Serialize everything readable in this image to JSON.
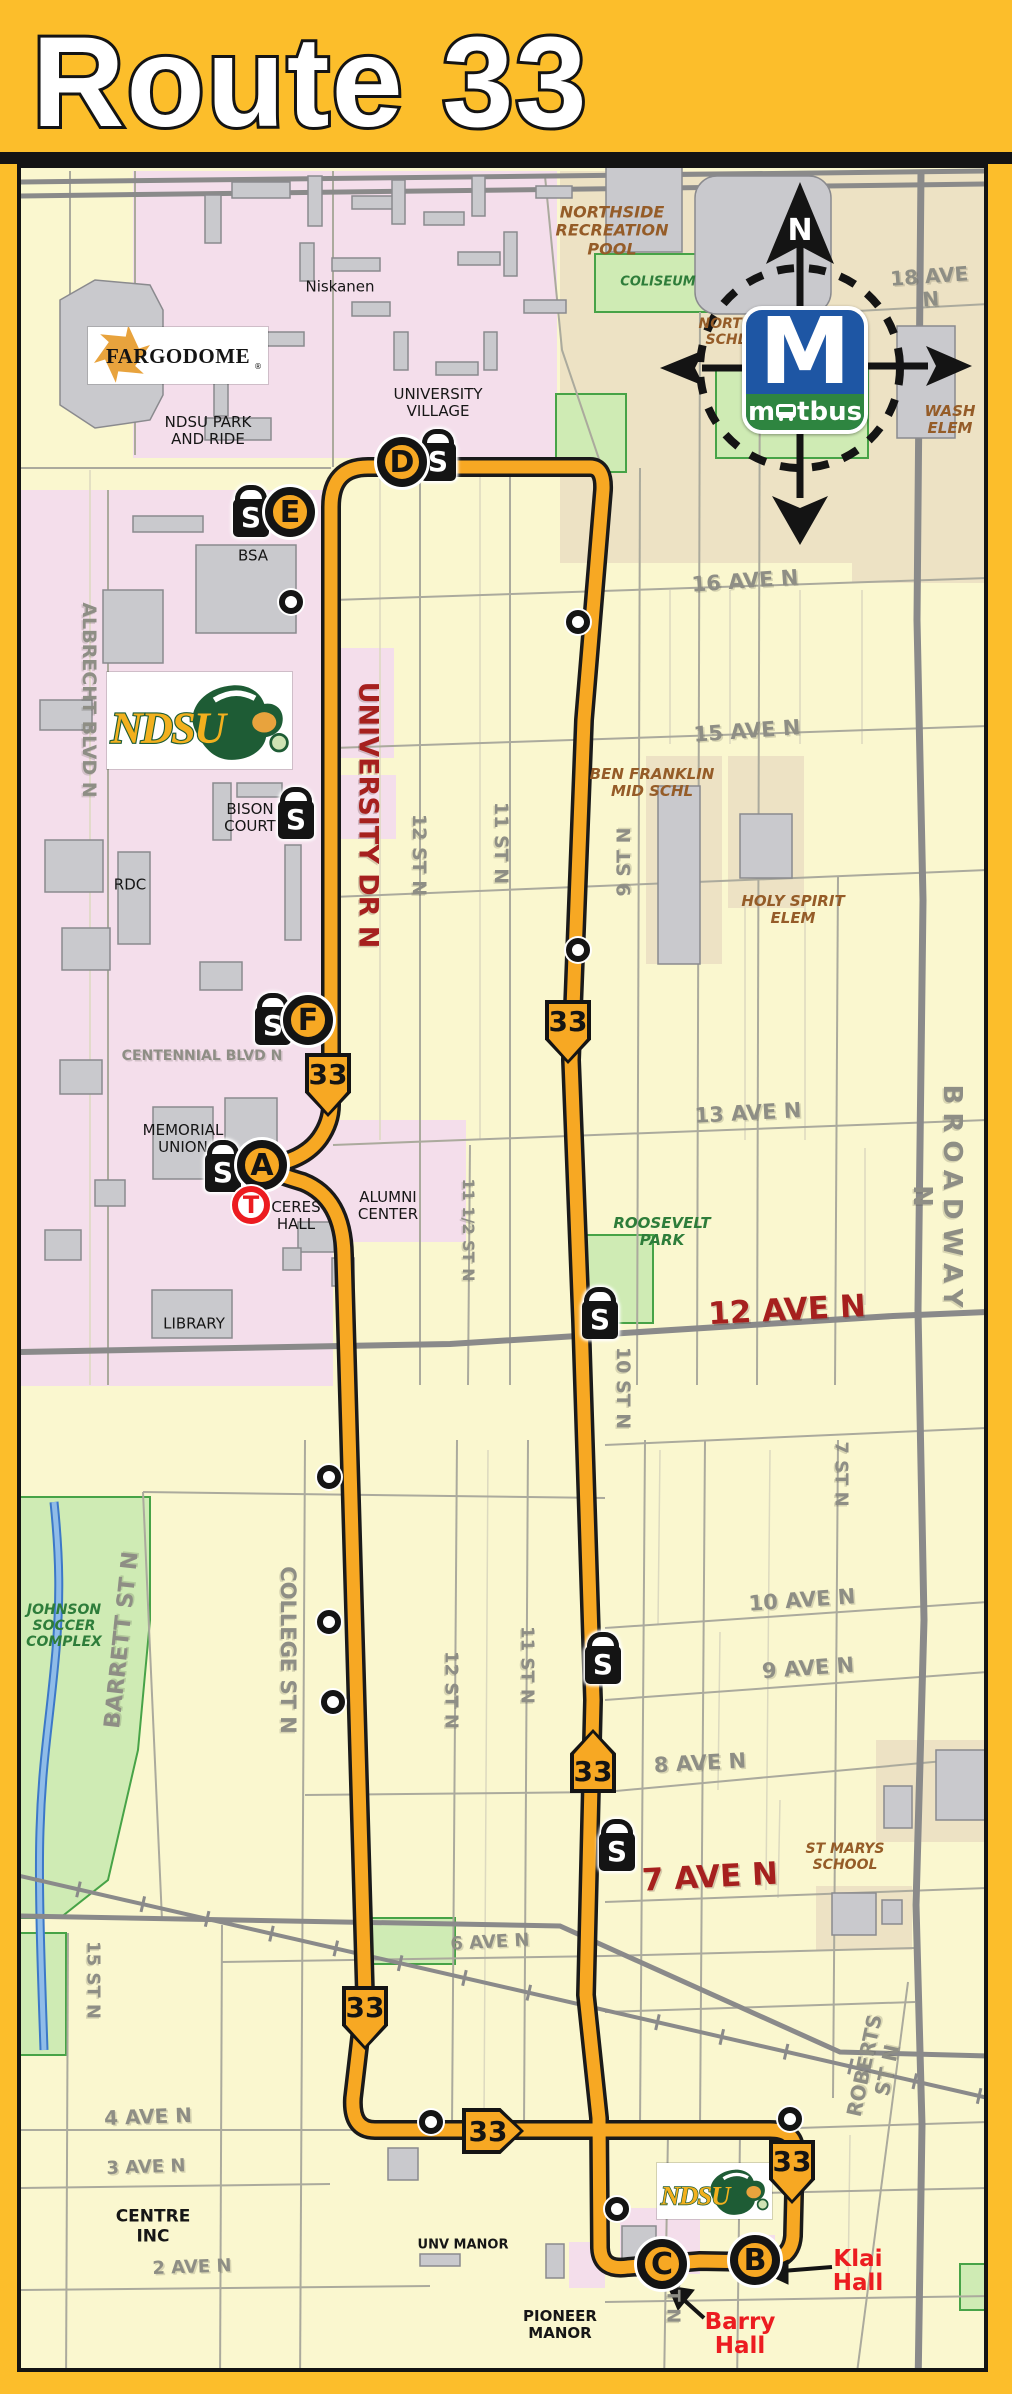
{
  "header": {
    "title": "Route 33"
  },
  "branding": {
    "matbus": {
      "m": "M",
      "word_pre": "m",
      "word_post": "tbus"
    },
    "fargodome": {
      "text": "FARGODOME",
      "reg": "®"
    },
    "ndsu": {
      "text": "NDSU"
    }
  },
  "compass": {
    "north_label": "N"
  },
  "route": {
    "number": "33",
    "color": "#F7A823"
  },
  "map_labels": [
    {
      "id": "street-18-ave-n",
      "t": "18 AVE N",
      "c": "g",
      "x": 930,
      "y": 288,
      "r": -4,
      "fs": 20
    },
    {
      "id": "street-16-ave-n",
      "t": "16 AVE N",
      "c": "g",
      "x": 745,
      "y": 581,
      "r": -4,
      "fs": 21
    },
    {
      "id": "street-15-ave-n",
      "t": "15 AVE N",
      "c": "g",
      "x": 747,
      "y": 731,
      "r": -4,
      "fs": 21
    },
    {
      "id": "street-13-ave-n",
      "t": "13 AVE N",
      "c": "g",
      "x": 748,
      "y": 1113,
      "r": -3,
      "fs": 21
    },
    {
      "id": "street-10-ave-n",
      "t": "10 AVE N",
      "c": "g",
      "x": 802,
      "y": 1600,
      "r": -4,
      "fs": 21
    },
    {
      "id": "street-9-ave-n",
      "t": "9 AVE N",
      "c": "g",
      "x": 808,
      "y": 1668,
      "r": -4,
      "fs": 21
    },
    {
      "id": "street-8-ave-n",
      "t": "8 AVE N",
      "c": "g",
      "x": 700,
      "y": 1763,
      "r": -3,
      "fs": 21
    },
    {
      "id": "street-6-ave-n",
      "t": "6 AVE N",
      "c": "g",
      "x": 490,
      "y": 1943,
      "r": -3,
      "fs": 18
    },
    {
      "id": "street-4-ave-n",
      "t": "4 AVE N",
      "c": "g",
      "x": 148,
      "y": 2117,
      "r": -2,
      "fs": 20
    },
    {
      "id": "street-3-ave-n",
      "t": "3 AVE N",
      "c": "g",
      "x": 146,
      "y": 2168,
      "r": -2,
      "fs": 18
    },
    {
      "id": "street-2-ave-n",
      "t": "2 AVE N",
      "c": "g",
      "x": 192,
      "y": 2268,
      "r": -2,
      "fs": 18
    },
    {
      "id": "street-centennial",
      "t": "CENTENNIAL BLVD N",
      "c": "g",
      "x": 202,
      "y": 1056,
      "r": 0,
      "fs": 14
    },
    {
      "id": "street-albrecht",
      "t": "ALBRECHT BLVD N",
      "c": "g",
      "x": 88,
      "y": 700,
      "r": 90,
      "fs": 19
    },
    {
      "id": "street-12-st-n-upper",
      "t": "12 ST N",
      "c": "g",
      "x": 418,
      "y": 855,
      "r": 90,
      "fs": 19
    },
    {
      "id": "street-11-st-n-upper",
      "t": "11 ST N",
      "c": "g",
      "x": 500,
      "y": 843,
      "r": 90,
      "fs": 19
    },
    {
      "id": "street-11half-st-n",
      "t": "11 1/2 ST N",
      "c": "g",
      "x": 468,
      "y": 1230,
      "r": 90,
      "fs": 16
    },
    {
      "id": "street-10-st-n",
      "t": "10 ST N",
      "c": "g",
      "x": 622,
      "y": 1388,
      "r": 90,
      "fs": 19
    },
    {
      "id": "street-7-st-n",
      "t": "7 ST N",
      "c": "g",
      "x": 840,
      "y": 1474,
      "r": 90,
      "fs": 18
    },
    {
      "id": "street-broadway-n",
      "t": "BROADWAY N",
      "c": "g",
      "x": 936,
      "y": 1200,
      "r": 90,
      "fs": 26,
      "ls": 8
    },
    {
      "id": "street-college-st-n",
      "t": "COLLEGE ST N",
      "c": "g",
      "x": 288,
      "y": 1650,
      "r": 90,
      "fs": 21
    },
    {
      "id": "street-12-st-n-lower",
      "t": "12 ST N",
      "c": "g",
      "x": 450,
      "y": 1690,
      "r": 90,
      "fs": 18
    },
    {
      "id": "street-11-st-n-lower",
      "t": "11 ST N",
      "c": "g",
      "x": 526,
      "y": 1665,
      "r": 90,
      "fs": 18
    },
    {
      "id": "street-15-st-n",
      "t": "15 ST N",
      "c": "g",
      "x": 92,
      "y": 1980,
      "r": 90,
      "fs": 18
    },
    {
      "id": "street-st-n",
      "t": "ST N",
      "c": "g",
      "x": 672,
      "y": 2300,
      "r": 90,
      "fs": 18
    },
    {
      "id": "street-9-st-n",
      "t": "9 ST N",
      "c": "g",
      "x": 625,
      "y": 862,
      "r": -90,
      "fs": 19
    },
    {
      "id": "street-barrett-st-n",
      "t": "BARRETT ST N",
      "c": "g",
      "x": 122,
      "y": 1640,
      "r": -84,
      "fs": 22
    },
    {
      "id": "street-roberts-st-n",
      "t": "ROBERTS ST N",
      "c": "g",
      "x": 876,
      "y": 2068,
      "r": -78,
      "fs": 20
    },
    {
      "id": "street-12-ave-n",
      "t": "12 AVE N",
      "c": "r",
      "x": 787,
      "y": 1311,
      "r": -3,
      "fs": 31
    },
    {
      "id": "street-7-ave-n",
      "t": "7 AVE N",
      "c": "r",
      "x": 710,
      "y": 1878,
      "r": -3,
      "fs": 31
    },
    {
      "id": "street-university-dr-n",
      "t": "UNIVERSITY DR N",
      "c": "r",
      "x": 368,
      "y": 815,
      "r": 90,
      "fs": 27
    },
    {
      "id": "place-niskanen",
      "t": "Niskanen",
      "c": "p",
      "x": 340,
      "y": 287,
      "r": 0,
      "fs": 15
    },
    {
      "id": "place-university-village",
      "t": "UNIVERSITY\nVILLAGE",
      "c": "p",
      "x": 438,
      "y": 403,
      "r": 0,
      "fs": 15
    },
    {
      "id": "place-ndsu-park-and-ride",
      "t": "NDSU PARK\nAND RIDE",
      "c": "p",
      "x": 208,
      "y": 431,
      "r": 0,
      "fs": 15
    },
    {
      "id": "place-bsa",
      "t": "BSA",
      "c": "p",
      "x": 253,
      "y": 556,
      "r": 0,
      "fs": 15
    },
    {
      "id": "place-bison-court",
      "t": "BISON\nCOURT",
      "c": "p",
      "x": 250,
      "y": 818,
      "r": 0,
      "fs": 15
    },
    {
      "id": "place-rdc",
      "t": "RDC",
      "c": "p",
      "x": 130,
      "y": 885,
      "r": 0,
      "fs": 15
    },
    {
      "id": "place-memorial-union",
      "t": "MEMORIAL\nUNION",
      "c": "p",
      "x": 183,
      "y": 1139,
      "r": 0,
      "fs": 15
    },
    {
      "id": "place-ceres-hall",
      "t": "CERES\nHALL",
      "c": "p",
      "x": 296,
      "y": 1216,
      "r": 0,
      "fs": 15
    },
    {
      "id": "place-alumni-center",
      "t": "ALUMNI\nCENTER",
      "c": "p",
      "x": 388,
      "y": 1206,
      "r": 0,
      "fs": 15
    },
    {
      "id": "place-library",
      "t": "LIBRARY",
      "c": "p",
      "x": 194,
      "y": 1324,
      "r": 0,
      "fs": 15
    },
    {
      "id": "place-centre-inc",
      "t": "CENTRE\nINC",
      "c": "p",
      "x": 153,
      "y": 2227,
      "r": 0,
      "fs": 17,
      "b": 1
    },
    {
      "id": "place-unv-manor",
      "t": "UNV MANOR",
      "c": "p",
      "x": 463,
      "y": 2246,
      "r": 0,
      "fs": 13,
      "b": 1
    },
    {
      "id": "place-pioneer-manor",
      "t": "PIONEER\nMANOR",
      "c": "p",
      "x": 560,
      "y": 2325,
      "r": 0,
      "fs": 15,
      "b": 1
    },
    {
      "id": "place-northside-pool",
      "t": "NORTHSIDE\nRECREATION\nPOOL",
      "c": "b",
      "x": 612,
      "y": 231,
      "r": 0,
      "fs": 16
    },
    {
      "id": "place-north-schl",
      "t": "NORTH\nSCHL",
      "c": "b",
      "x": 726,
      "y": 332,
      "r": 0,
      "fs": 14
    },
    {
      "id": "place-wash-elem",
      "t": "WASH\nELEM",
      "c": "b",
      "x": 950,
      "y": 420,
      "r": 0,
      "fs": 15
    },
    {
      "id": "place-ben-franklin",
      "t": "BEN FRANKLIN\nMID SCHL",
      "c": "b",
      "x": 652,
      "y": 783,
      "r": 0,
      "fs": 15
    },
    {
      "id": "place-holy-spirit",
      "t": "HOLY SPIRIT\nELEM",
      "c": "b",
      "x": 793,
      "y": 910,
      "r": 0,
      "fs": 15
    },
    {
      "id": "place-st-marys",
      "t": "ST MARYS\nSCHOOL",
      "c": "b",
      "x": 845,
      "y": 1857,
      "r": 0,
      "fs": 14
    },
    {
      "id": "place-coliseum",
      "t": "COLISEUM",
      "c": "gr",
      "x": 658,
      "y": 283,
      "r": 0,
      "fs": 13
    },
    {
      "id": "place-roosevelt-park",
      "t": "ROOSEVELT\nPARK",
      "c": "gr",
      "x": 662,
      "y": 1232,
      "r": 0,
      "fs": 15
    },
    {
      "id": "place-johnson-soccer",
      "t": "JOHNSON\nSOCCER\nCOMPLEX",
      "c": "gr",
      "x": 64,
      "y": 1626,
      "r": 0,
      "fs": 14
    },
    {
      "id": "poi-klai-hall",
      "t": "Klai\nHall",
      "c": "poi",
      "x": 858,
      "y": 2271,
      "r": 0,
      "fs": 23
    },
    {
      "id": "poi-barry-hall",
      "t": "Barry\nHall",
      "c": "poi",
      "x": 740,
      "y": 2334,
      "r": 0,
      "fs": 23
    }
  ],
  "stops": {
    "lettered": [
      {
        "letter": "A",
        "x": 262,
        "y": 1165
      },
      {
        "letter": "B",
        "x": 755,
        "y": 2260
      },
      {
        "letter": "C",
        "x": 662,
        "y": 2264
      },
      {
        "letter": "D",
        "x": 402,
        "y": 462
      },
      {
        "letter": "E",
        "x": 290,
        "y": 512
      },
      {
        "letter": "F",
        "x": 308,
        "y": 1020
      }
    ],
    "transfer": {
      "letter": "T",
      "x": 251,
      "y": 1205
    },
    "shelter_letter": "S",
    "shelters": [
      {
        "x": 251,
        "y": 511
      },
      {
        "x": 438,
        "y": 455
      },
      {
        "x": 296,
        "y": 813
      },
      {
        "x": 273,
        "y": 1019
      },
      {
        "x": 223,
        "y": 1166
      },
      {
        "x": 600,
        "y": 1313
      },
      {
        "x": 603,
        "y": 1658
      },
      {
        "x": 617,
        "y": 1845
      }
    ],
    "minor": [
      {
        "x": 291,
        "y": 602
      },
      {
        "x": 578,
        "y": 622
      },
      {
        "x": 578,
        "y": 950
      },
      {
        "x": 329,
        "y": 1477
      },
      {
        "x": 329,
        "y": 1622
      },
      {
        "x": 333,
        "y": 1702
      },
      {
        "x": 431,
        "y": 2122
      },
      {
        "x": 790,
        "y": 2119
      },
      {
        "x": 617,
        "y": 2209
      }
    ],
    "shields": [
      {
        "dir": "down",
        "x": 328,
        "y": 1085
      },
      {
        "dir": "down",
        "x": 568,
        "y": 1032
      },
      {
        "dir": "up",
        "x": 593,
        "y": 1761
      },
      {
        "dir": "down",
        "x": 365,
        "y": 2018
      },
      {
        "dir": "right",
        "x": 493,
        "y": 2131
      },
      {
        "dir": "down",
        "x": 792,
        "y": 2172
      }
    ]
  }
}
